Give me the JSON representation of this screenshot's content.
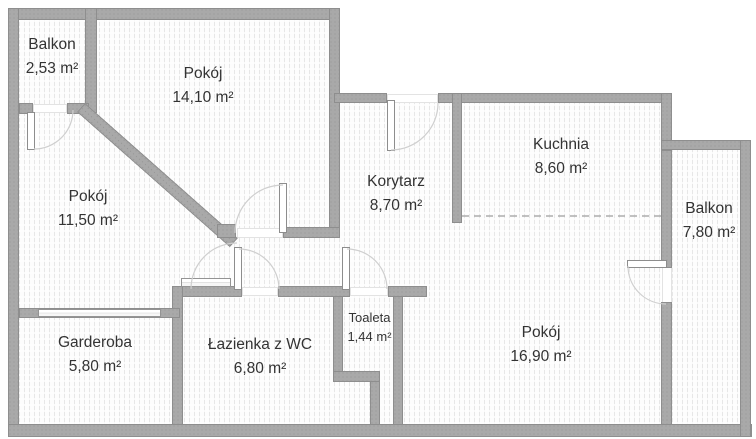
{
  "plan": {
    "rooms": [
      {
        "id": "balkon-north",
        "name": "Balkon",
        "area": "2,53 m²"
      },
      {
        "id": "pokoj-north",
        "name": "Pokój",
        "area": "14,10 m²"
      },
      {
        "id": "pokoj-west",
        "name": "Pokój",
        "area": "11,50 m²"
      },
      {
        "id": "korytarz",
        "name": "Korytarz",
        "area": "8,70 m²"
      },
      {
        "id": "kuchnia",
        "name": "Kuchnia",
        "area": "8,60 m²"
      },
      {
        "id": "balkon-east",
        "name": "Balkon",
        "area": "7,80 m²"
      },
      {
        "id": "garderoba",
        "name": "Garderoba",
        "area": "5,80 m²"
      },
      {
        "id": "lazienka",
        "name": "Łazienka z WC",
        "area": "6,80 m²"
      },
      {
        "id": "toaleta",
        "name": "Toaleta",
        "area": "1,44 m²"
      },
      {
        "id": "pokoj-south",
        "name": "Pokój",
        "area": "16,90 m²"
      }
    ],
    "colors": {
      "wall": "#a9a9a9",
      "wall_edge": "#8e8e8e",
      "floor_hatch": "#e7e7e7",
      "text": "#333333",
      "door_arc": "#cfcfcf",
      "open_plan_divider": "#adadad"
    }
  }
}
